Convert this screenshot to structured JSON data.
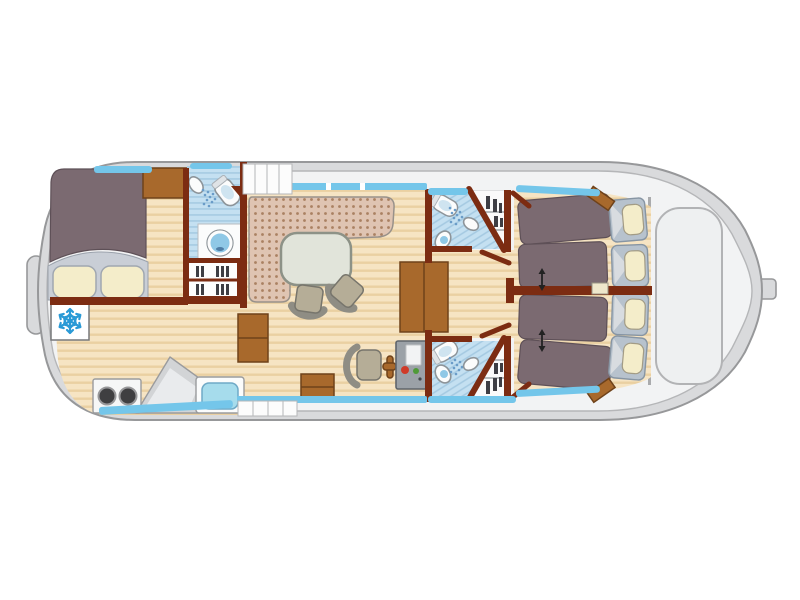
{
  "plan": {
    "kind": "houseboat-deck-floorplan",
    "orientation": "bow-left-stern-right",
    "rooms": [
      {
        "id": "bow-cabin",
        "fixtures": [
          "double-bed",
          "two-pillows",
          "wardrobe"
        ]
      },
      {
        "id": "forward-bathroom",
        "fixtures": [
          "shower",
          "toilet",
          "washbasin",
          "shelving"
        ]
      },
      {
        "id": "galley",
        "fixtures": [
          "fridge-freezer",
          "stove-two-burners",
          "worktop",
          "sink"
        ]
      },
      {
        "id": "salon",
        "fixtures": [
          "l-shaped-dinette",
          "table",
          "two-chairs",
          "storage-cabinets"
        ]
      },
      {
        "id": "helm-station",
        "fixtures": [
          "helm-seat",
          "steering-wheel",
          "control-console"
        ]
      },
      {
        "id": "aft-bathroom-port",
        "fixtures": [
          "shower",
          "toilet",
          "washbasin",
          "wardrobe"
        ]
      },
      {
        "id": "aft-bathroom-starboard",
        "fixtures": [
          "shower",
          "toilet",
          "washbasin",
          "wardrobe"
        ]
      },
      {
        "id": "aft-cabin-port",
        "fixtures": [
          "two-single-beds",
          "convertible-arrow"
        ]
      },
      {
        "id": "aft-cabin-starboard",
        "fixtures": [
          "two-single-beds",
          "convertible-arrow"
        ]
      },
      {
        "id": "stern-deck",
        "fixtures": [
          "engine-hatch",
          "rudder"
        ]
      }
    ],
    "accommodation": {
      "double_beds": 1,
      "single_beds": 4,
      "bathrooms": 3
    },
    "stairs": {
      "top_companionway_steps": 4,
      "bottom_companionway_steps": 4,
      "interior_step_chests": 2
    },
    "icons": [
      "snowflake-icon",
      "shower-spray-icon",
      "toilet-icon",
      "washbasin-icon",
      "stove-burner-icon",
      "steering-wheel-icon",
      "double-arrow-icon"
    ]
  },
  "colors": {
    "hull_band": "#d9dadc",
    "hull_stroke": "#97989a",
    "deck": "#f2f3f4",
    "deck_stroke": "#b5b6b8",
    "wall": "#7c2c12",
    "furniture": "#a8692c",
    "furniture_stroke": "#6f421a",
    "wood": "#f6e4c3",
    "wood_stripe": "#ead0a2",
    "blanket": "#7b6a71",
    "blanket_stroke": "#5e5057",
    "sheet": "#c9ced6",
    "sheet_fold": "#d8dce0",
    "pillow": "#f4edca",
    "pillow_frame": "#b7c2cd",
    "pillow_frame_stroke": "#8795a3",
    "cushion": "#dfc4b2",
    "cushion_dot": "#aa8162",
    "cushion_stroke": "#98918a",
    "tile": "#c4e0f1",
    "tile_stripe": "#a4c9e1",
    "window_blue": "#74c6ea",
    "fixture_white": "#fbfcfc",
    "fixture_stroke": "#8d9499",
    "basin_blue": "#8fc8e6",
    "table_fill": "#e1e4da",
    "table_stroke": "#8d9287",
    "chair_seat": "#b5ad97",
    "chair_back": "#8f8d84",
    "chair_stroke": "#77756c",
    "console": "#9ba1a7",
    "console_stroke": "#5f656c",
    "indicator_red": "#cf3a28",
    "indicator_green": "#4f9a38",
    "burner": "#3f3f41",
    "snowflake": "#2a9ad6",
    "arrow": "#222222",
    "step_fill": "#fcfcfc",
    "step_stroke": "#b5b6b8",
    "hatch_stroke": "#b2b3b5",
    "clothes": "#3e3e44",
    "counter": "#d2d4d6",
    "counter_light": "#e9ebed",
    "kitchen_sink": "#a6dcec",
    "kitchen_sink_stroke": "#6fa9c6",
    "nightstand": "#efe7cb"
  }
}
